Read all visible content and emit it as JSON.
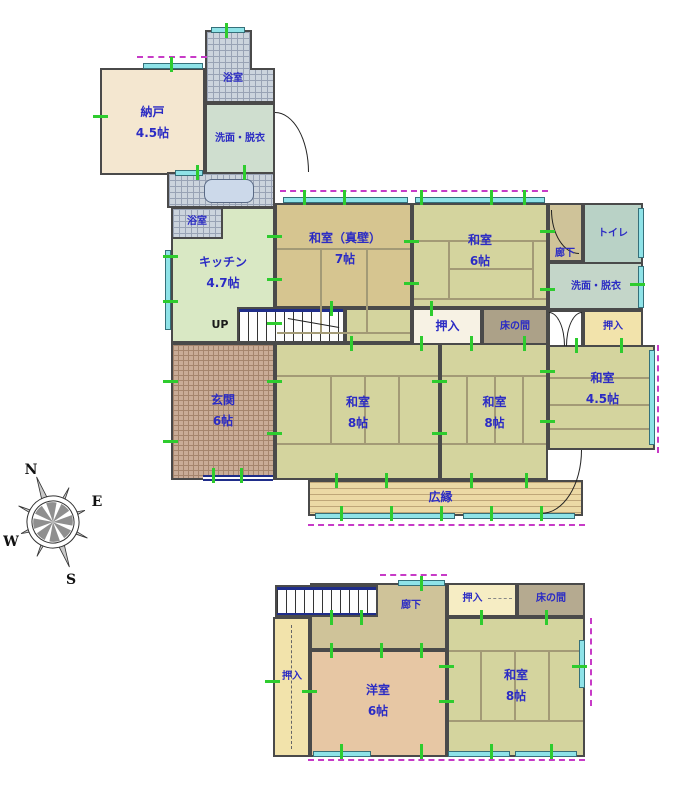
{
  "compass": {
    "north": "N",
    "east": "E",
    "south": "S",
    "west": "W"
  },
  "palette": {
    "label_blue": "#2b2bc4",
    "wall_gray": "#4a4a4a",
    "window_cyan": "#8fe3e8",
    "dashed_magenta": "#c73bc7",
    "tick_green": "#2ecc2e",
    "tatami_khaki": "#d4d49e",
    "wood_floor": "#ecd9a5",
    "stair_rail_navy": "#1f2d8a"
  },
  "floor1": {
    "storage": {
      "name": "納戸",
      "size": "4.5帖"
    },
    "bath_top": {
      "name": "浴室"
    },
    "washroom_annex": {
      "name": "洗面・脱衣"
    },
    "bath_mid": {
      "name": "浴室"
    },
    "kitchen": {
      "name": "キッチン",
      "size": "4.7帖"
    },
    "washitsu_shinkabe": {
      "name": "和室（真壁）",
      "size": "7帖"
    },
    "washitsu6": {
      "name": "和室",
      "size": "6帖"
    },
    "hallway": {
      "name": "廊下"
    },
    "toilet": {
      "name": "トイレ"
    },
    "washroom": {
      "name": "洗面・脱衣"
    },
    "closet_center": {
      "name": "押入"
    },
    "tokonoma": {
      "name": "床の間"
    },
    "closet_right": {
      "name": "押入"
    },
    "stairs": {
      "label": "UP"
    },
    "entrance": {
      "name": "玄関",
      "size": "6帖"
    },
    "washitsu8_left": {
      "name": "和室",
      "size": "8帖"
    },
    "washitsu8_right": {
      "name": "和室",
      "size": "8帖"
    },
    "washitsu45": {
      "name": "和室",
      "size": "4.5帖"
    },
    "veranda": {
      "name": "広縁"
    }
  },
  "floor2": {
    "hallway": {
      "name": "廊下"
    },
    "closet_top": {
      "name": "押入"
    },
    "tokonoma": {
      "name": "床の間"
    },
    "closet_left": {
      "name": "押入"
    },
    "western_room": {
      "name": "洋室",
      "size": "6帖"
    },
    "washitsu8": {
      "name": "和室",
      "size": "8帖"
    }
  }
}
